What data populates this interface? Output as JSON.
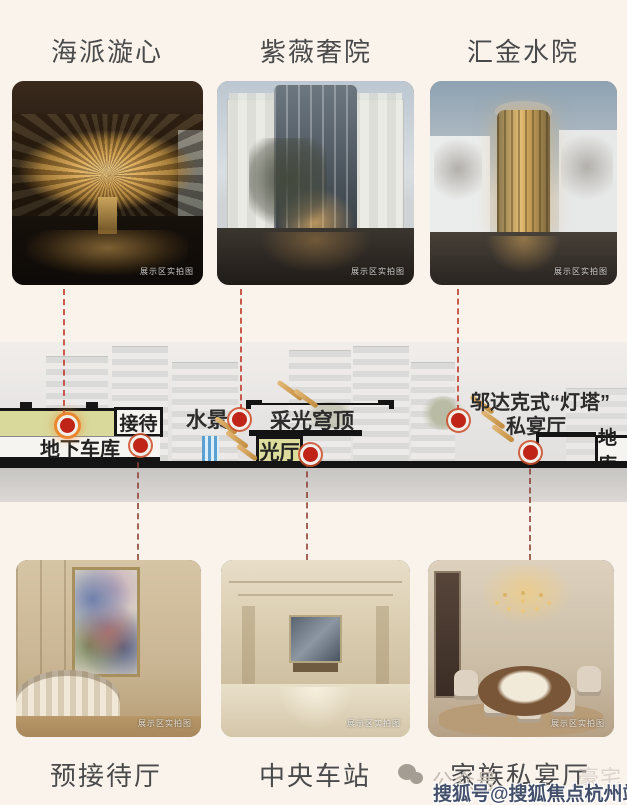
{
  "gallery_top": {
    "items": [
      {
        "title": "海派漩心",
        "caption": "展示区实拍图"
      },
      {
        "title": "紫薇奢院",
        "caption": "展示区实拍图"
      },
      {
        "title": "汇金水院",
        "caption": "展示区实拍图"
      }
    ]
  },
  "gallery_bottom": {
    "items": [
      {
        "title": "预接待厅",
        "caption": "展示区实拍图"
      },
      {
        "title": "中央车站",
        "caption": "展示区实拍图"
      },
      {
        "title": "家族私宴厅",
        "caption": "展示区实拍图"
      }
    ]
  },
  "diagram": {
    "labels": {
      "reception": "接待",
      "water_feature": "水景",
      "daylight_dome": "采光穹顶",
      "underground_garage": "地下车库",
      "light_hall": "光厅",
      "hudec_lighthouse": "邬达克式“灯塔”",
      "private_banquet": "私宴厅",
      "basement": "地库"
    }
  },
  "watermarks": {
    "wechat_label": "公众号",
    "faint_text": "豪宅",
    "sohu_watermark": "搜狐号@搜狐焦点杭州站"
  },
  "colors": {
    "background": "#faf3ec",
    "highlight_green": "#d9d99c",
    "marker_red": "#bf2417",
    "arrow_orange": "#d8a35c",
    "ground_gray": "#c7c5c3"
  }
}
